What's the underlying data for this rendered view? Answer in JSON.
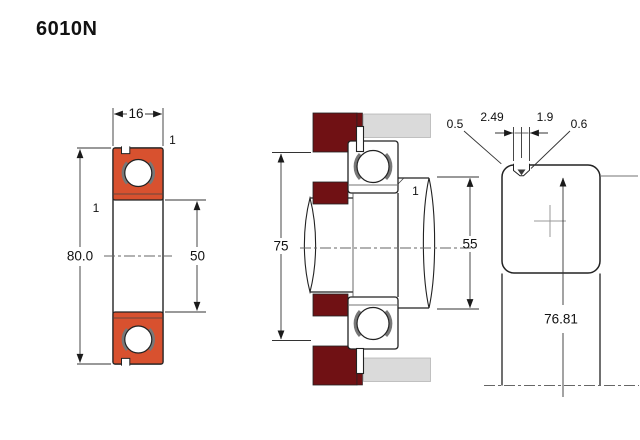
{
  "title": "6010N",
  "front_view": {
    "width": "16",
    "outer_diameter": "80.0",
    "bore_diameter": "50",
    "chamfer_outer": "1",
    "chamfer_inner": "1"
  },
  "mounted_view": {
    "housing_shoulder_diameter": "75",
    "shaft_shoulder_diameter": "55",
    "chamfer": "1"
  },
  "groove_detail_view": {
    "land_width": "0.5",
    "groove_width_top": "2.49",
    "groove_width_bottom": "1.9",
    "groove_edge_radius": "0.6",
    "snap_ring_groove_diameter": "76.81"
  },
  "colors": {
    "bearing_section": "#d8512f",
    "housing_section": "#701114",
    "housing_light": "#dadada"
  }
}
